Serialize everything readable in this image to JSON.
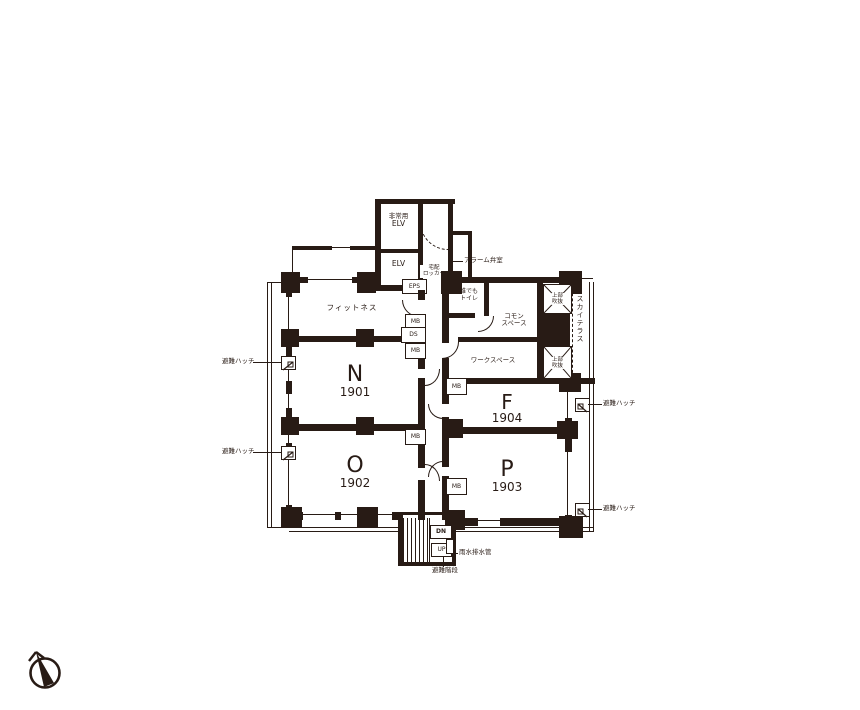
{
  "colors": {
    "ink": "#281b15",
    "background": "#ffffff"
  },
  "core": {
    "emergency_elevator": {
      "line1": "非常用",
      "line2": "ELV"
    },
    "elevator": "ELV",
    "eps": "EPS",
    "delivery_locker": {
      "line1": "宅配",
      "line2": "ロッカー"
    },
    "alarm_valve_room": "アラーム弁室"
  },
  "areas": {
    "fitness": "フィットネス",
    "accessible_toilet": {
      "line1": "誰でも",
      "line2": "トイレ"
    },
    "common_space": {
      "line1": "コモン",
      "line2": "スペース"
    },
    "workspace": "ワークスペース",
    "sky_terrace": "スカイテラス",
    "void_above": {
      "line1": "上部",
      "line2": "吹抜"
    }
  },
  "rooms": [
    {
      "letter": "N",
      "number": "1901"
    },
    {
      "letter": "O",
      "number": "1902"
    },
    {
      "letter": "P",
      "number": "1903"
    },
    {
      "letter": "F",
      "number": "1904"
    }
  ],
  "equipment": {
    "mb": "MB",
    "ds": "DS",
    "evacuation_hatch": "避難ハッチ"
  },
  "stairs": {
    "up": "UP",
    "down": "DN",
    "label": "避難階段"
  },
  "annotations": {
    "rain_water_drain": "雨水排水管"
  }
}
